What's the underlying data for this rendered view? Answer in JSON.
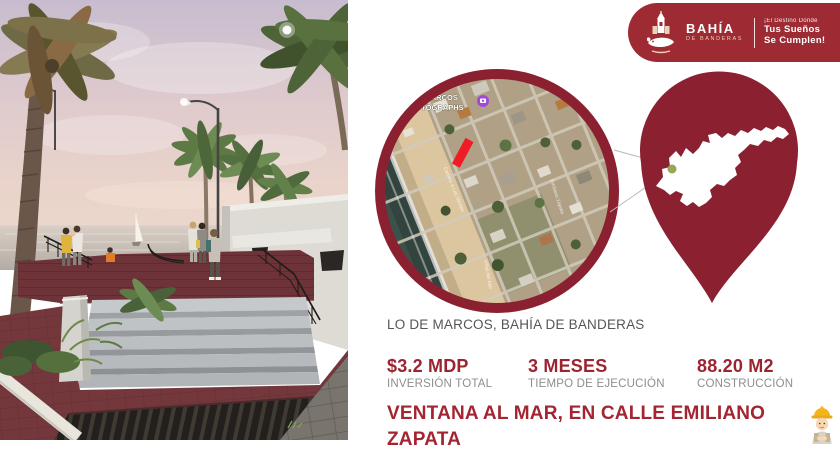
{
  "badge": {
    "brand_name": "BAHÍA",
    "brand_sub": "DE BANDERAS",
    "tagline_pre": "¡El Destino Donde",
    "tagline_line1": "Tus Sueños",
    "tagline_line2": "Se Cumplen!"
  },
  "map": {
    "poi_label_line1": "DE MARCOS",
    "poi_label_line2": "PHOTOGRAPHS",
    "street_labels": [
      "Camino a Las Minitas",
      "Villas del Mar",
      "Emiliano Zapata"
    ],
    "caption": "LO DE MARCOS, BAHÍA DE BANDERAS"
  },
  "stats": [
    {
      "value": "$3.2 MDP",
      "label": "INVERSIÓN TOTAL"
    },
    {
      "value": "3 MESES",
      "label": "TIEMPO DE EJECUCIÓN"
    },
    {
      "value": "88.20 M2",
      "label": "CONSTRUCCIÓN"
    }
  ],
  "project": {
    "title": "VENTANA AL MAR, EN CALLE EMILIANO ZAPATA"
  },
  "colors": {
    "brand_red": "#9e2a33",
    "pin_red": "#8a2030",
    "accent_red": "#a32532",
    "stat_value_red": "#9c2430",
    "label_gray": "#8d8d8d",
    "caption_gray": "#565656",
    "marker_red": "#ee1c24",
    "location_dot_green": "#97a757"
  }
}
